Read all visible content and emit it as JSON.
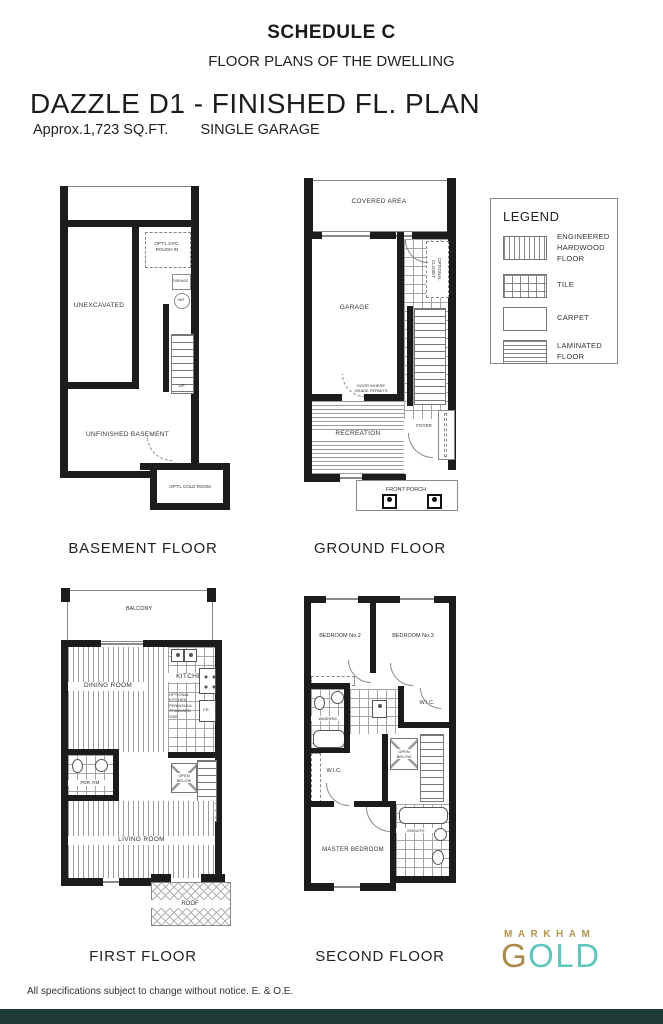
{
  "header": {
    "schedule_title": "SCHEDULE C",
    "schedule_subtitle": "FLOOR PLANS OF THE DWELLING",
    "plan_title": "DAZZLE D1 - FINISHED FL. PLAN",
    "plan_area": "Approx.1,723 SQ.FT.",
    "plan_garage": "SINGLE GARAGE"
  },
  "legend": {
    "title": "LEGEND",
    "items": [
      {
        "label": "ENGINEERED HARDWOOD FLOOR",
        "pattern": "vertical-lines"
      },
      {
        "label": "TILE",
        "pattern": "grid"
      },
      {
        "label": "CARPET",
        "pattern": "plain"
      },
      {
        "label": "LAMINATED FLOOR",
        "pattern": "horizontal-lines"
      }
    ]
  },
  "floors": {
    "basement": {
      "caption": "BASEMENT FLOOR",
      "rooms": {
        "unexcavated": "UNEXCAVATED",
        "rough_in": "OPT'L 3-PC.\nROUGH IN",
        "furnace": "FURNACE",
        "hwt": "HWT",
        "up": "UP",
        "unfinished": "UNFINISHED BASEMENT",
        "cold_room": "OPT'L COLD ROOM"
      }
    },
    "ground": {
      "caption": "GROUND FLOOR",
      "rooms": {
        "covered_area": "COVERED AREA",
        "garage": "GARAGE",
        "optional_closet": "OPTIONAL\nCLOSET",
        "door_note": "DOOR WHERE\nGRADE PERMITS",
        "recreation": "RECREATION",
        "foyer": "FOYER",
        "front_porch": "FRONT PORCH"
      }
    },
    "first": {
      "caption": "FIRST FLOOR",
      "rooms": {
        "balcony": "BALCONY",
        "dining": "DINING ROOM",
        "kitchen": "KITCHEN",
        "kitchen_note": "OPTIONAL\nKITCHEN\nPENINSULA\nSTANDARD\nSIZE",
        "fridge": "FR.",
        "pdr": "PDR. RM.",
        "open_below": "OPEN\nBELOW",
        "living": "LIVING ROOM",
        "roof": "ROOF"
      }
    },
    "second": {
      "caption": "SECOND FLOOR",
      "rooms": {
        "bedroom2": "BEDROOM No.2",
        "bedroom3": "BEDROOM No.3",
        "washrm": "WASHRM",
        "wic_a": "W.I.C.",
        "open_below": "OPEN\nBELOW",
        "wic_b": "W.I.C.",
        "master": "MASTER BEDROOM",
        "ensuite": "ENSUITE"
      }
    }
  },
  "logo": {
    "markham": "MARKHAM",
    "gold_g": "G",
    "gold_old": "OLD",
    "gold_color": "#ab8a4d",
    "teal_color": "#5fc5bd"
  },
  "footer": {
    "disclaimer": "All specifications subject to change without notice. E. & O.E."
  }
}
